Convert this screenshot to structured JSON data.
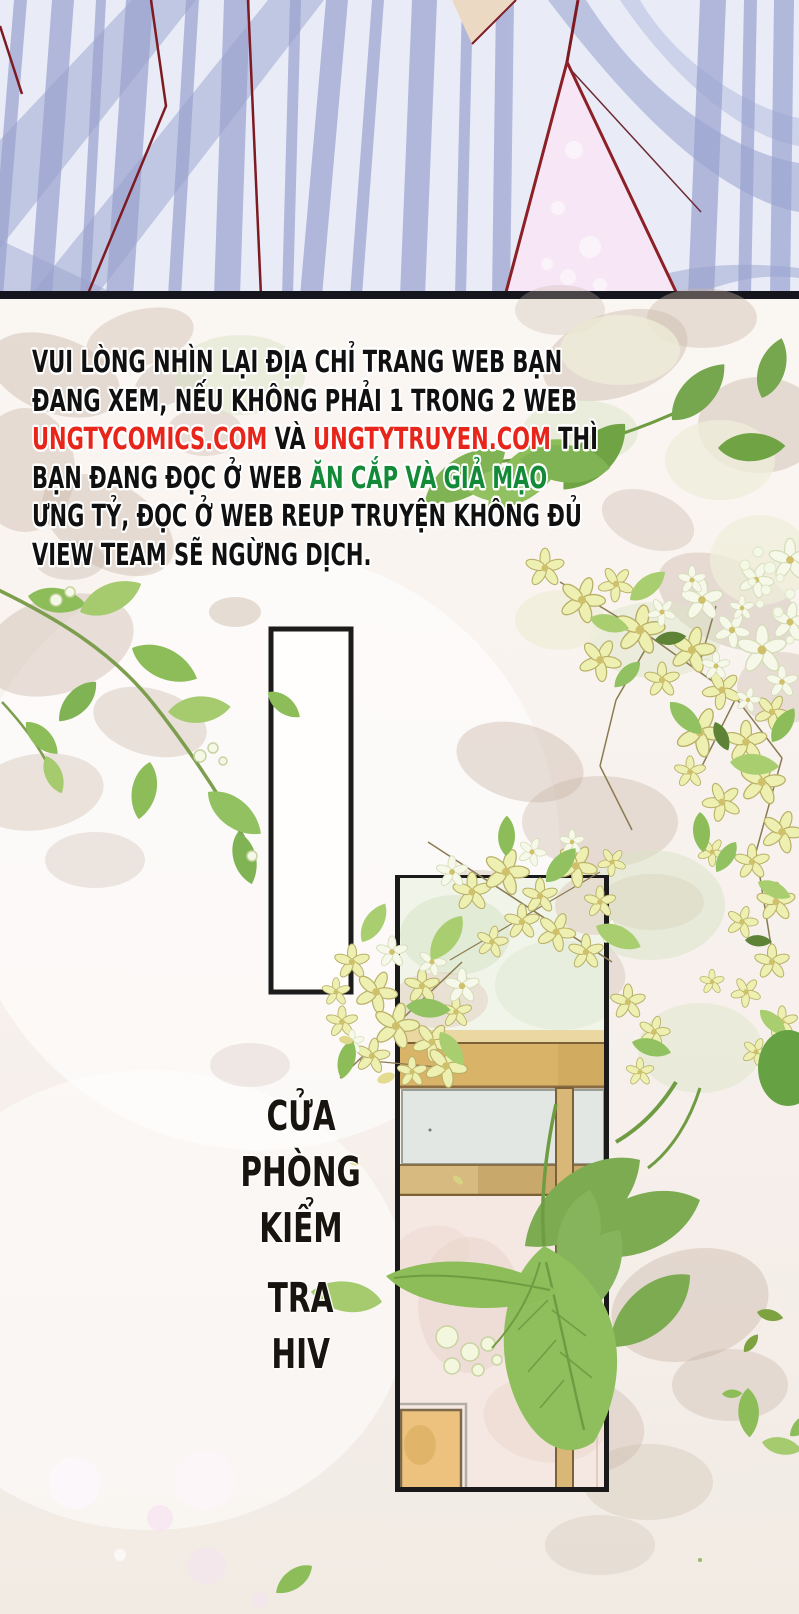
{
  "page": {
    "type": "comic_page",
    "language": "Vietnamese",
    "width_px": 799,
    "height_px": 1614
  },
  "notice": {
    "lines": [
      {
        "segments": [
          {
            "text": "VUI LÒNG NHÌN LẠI ĐỊA CHỈ TRANG WEB BẠN",
            "style": "black"
          }
        ]
      },
      {
        "segments": [
          {
            "text": "ĐANG XEM, NẾU KHÔNG PHẢI 1 TRONG 2 WEB",
            "style": "black"
          }
        ]
      },
      {
        "segments": [
          {
            "text": "UNGTYCOMICS.COM",
            "style": "red"
          },
          {
            "text": " VÀ ",
            "style": "black"
          },
          {
            "text": "UNGTYTRUYEN.COM",
            "style": "red"
          },
          {
            "text": " THÌ",
            "style": "black"
          }
        ]
      },
      {
        "segments": [
          {
            "text": "BẠN ĐANG ĐỌC Ở WEB ",
            "style": "black"
          },
          {
            "text": "ĂN CẮP VÀ GIẢ MẠO",
            "style": "green"
          }
        ]
      },
      {
        "segments": [
          {
            "text": "ƯNG TỶ, ĐỌC Ở WEB REUP TRUYỆN KHÔNG ĐỦ",
            "style": "black"
          }
        ]
      },
      {
        "segments": [
          {
            "text": "VIEW TEAM SẼ NGỪNG DỊCH.",
            "style": "black"
          }
        ]
      }
    ]
  },
  "caption": {
    "full_text": "CỬA PHÒNG KIỂM TRA HIV",
    "words": [
      "CỬA",
      "PHÒNG",
      "KIỂM",
      "TRA",
      "HIV"
    ]
  },
  "colors": {
    "notice_black": "#101010",
    "notice_red": "#e8251b",
    "notice_green": "#128a38",
    "caption_black": "#18140f",
    "fabric_base": "#e9ecf7",
    "fabric_stripe": "#aab2d8",
    "fabric_fold": "#98a2cd",
    "seam_red": "#7d1a22",
    "gap_pink": "#f7e6f6",
    "skin_tone": "#ecd9c4",
    "divider_black": "#15151d",
    "panel_border_black": "#1c1c1c",
    "leaf_green": "#8cbd58",
    "flower_yellow": "#eef0b2",
    "flower_white": "#f6f9ea",
    "shadow_tan": "#c8b5a6",
    "wood_tan": "#d9b468",
    "sign_gray": "#e3e7e4",
    "wall_pink": "#f5e8e3"
  }
}
